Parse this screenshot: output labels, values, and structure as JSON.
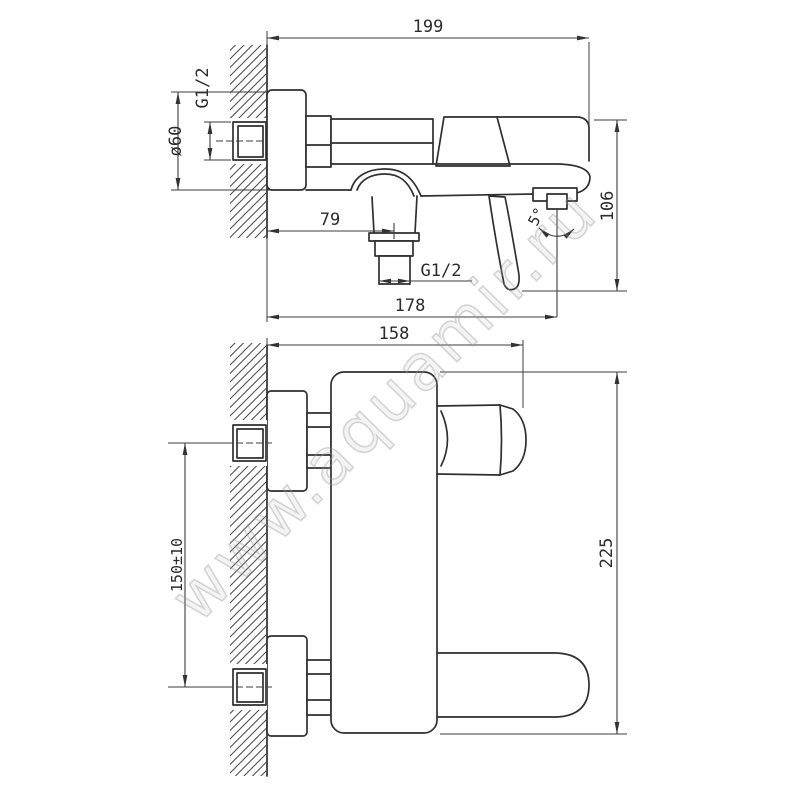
{
  "watermark": {
    "text": "www.aquamir.ru"
  },
  "side_view": {
    "dims": {
      "total_length": "199",
      "inlet_thread": "G1/2",
      "escutcheon_diameter": "ø60",
      "spout_offset": "79",
      "outlet_thread": "G1/2",
      "length_to_outlet_axis": "178",
      "height": "106",
      "handle_swing_angle": "5°"
    }
  },
  "front_view": {
    "dims": {
      "width": "158",
      "inlet_spacing": "150±10",
      "overall_height": "225"
    }
  }
}
